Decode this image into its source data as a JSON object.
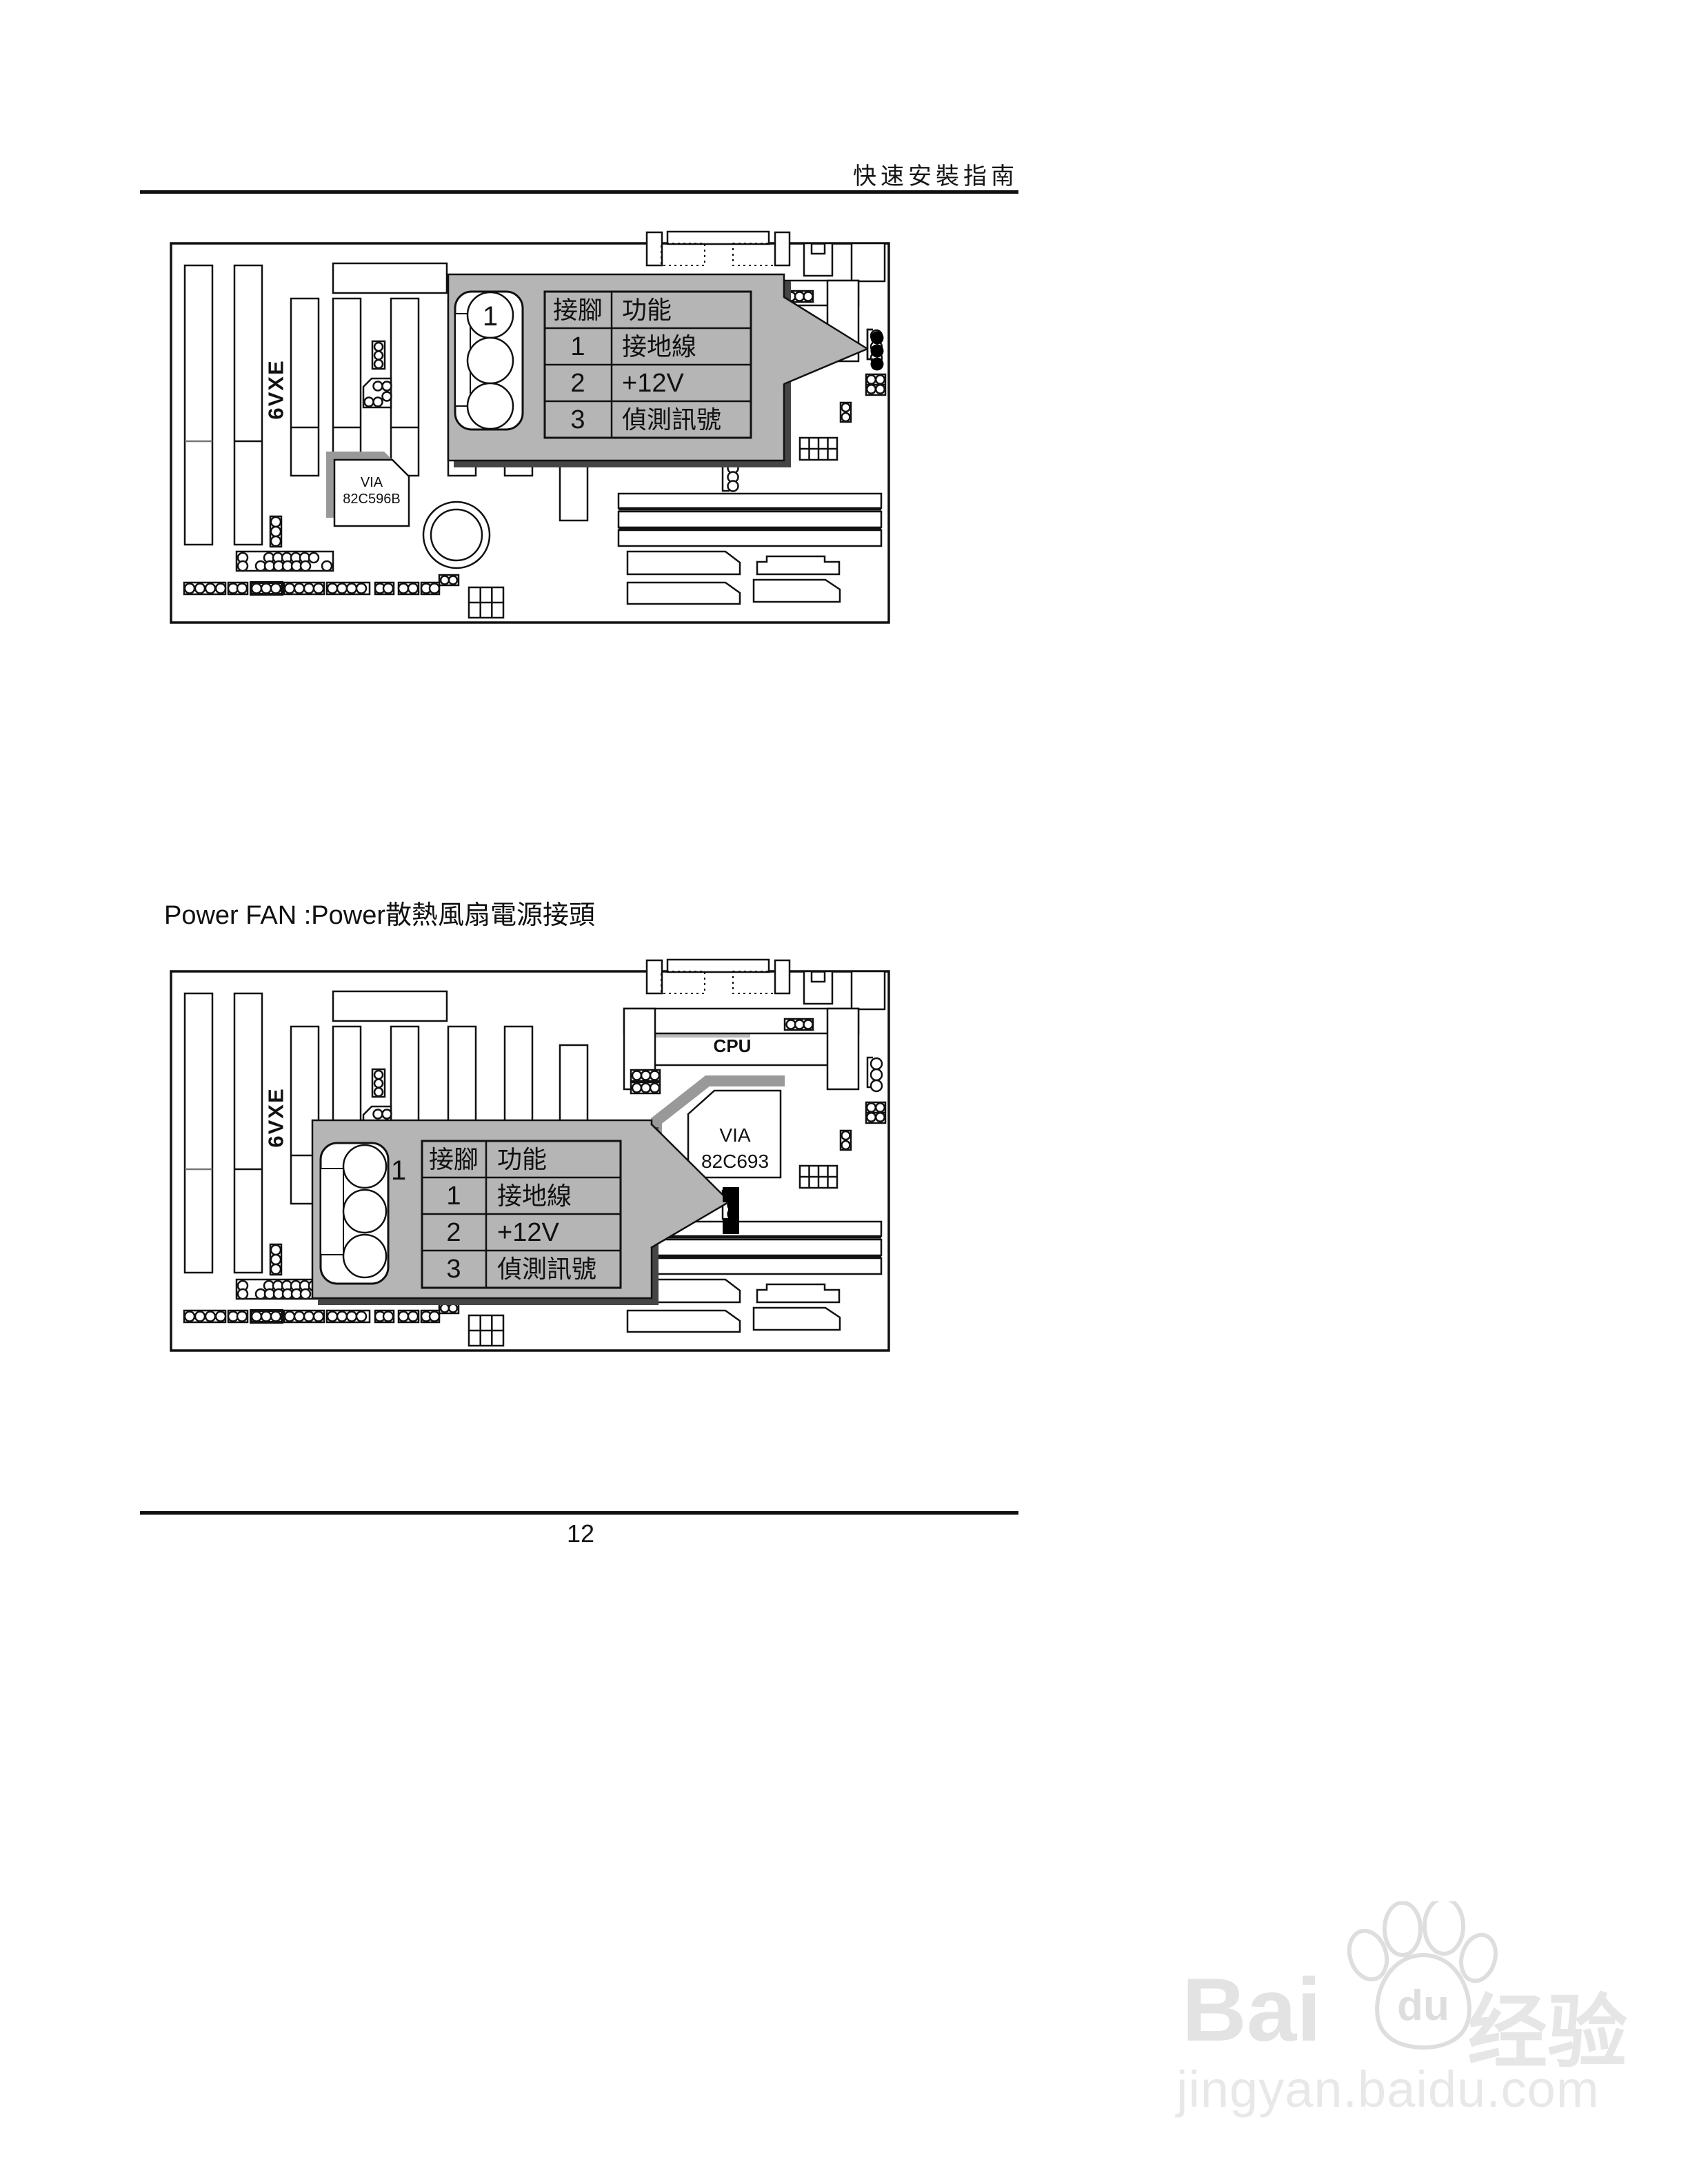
{
  "page": {
    "header_title": "快速安裝指南",
    "page_number": "12",
    "section_heading": {
      "latin": "Power FAN :Power",
      "cjk": "散熱風扇電源接頭"
    }
  },
  "board": {
    "model": "6VXE",
    "cpu_label": "CPU",
    "chip_north": {
      "line1": "VIA",
      "line2": "82C693"
    },
    "chip_south": {
      "line1": "VIA",
      "line2": "82C596B"
    }
  },
  "fan_table": {
    "pin1_marker": "1",
    "header": {
      "pin": "接腳",
      "func": "功能"
    },
    "rows": [
      {
        "pin": "1",
        "func": "接地線"
      },
      {
        "pin": "2",
        "func": "+12V"
      },
      {
        "pin": "3",
        "func": "偵測訊號"
      }
    ]
  },
  "watermark": {
    "bai": "Bai",
    "du": "du",
    "cjk": "经验",
    "url": "jingyan.baidu.com"
  },
  "colors": {
    "callout_gray": "#b5b5b5",
    "callout_shadow": "#454545",
    "chip_shadow": "#999999",
    "line_black": "#111111",
    "watermark_gray": "#e3e3e3"
  }
}
